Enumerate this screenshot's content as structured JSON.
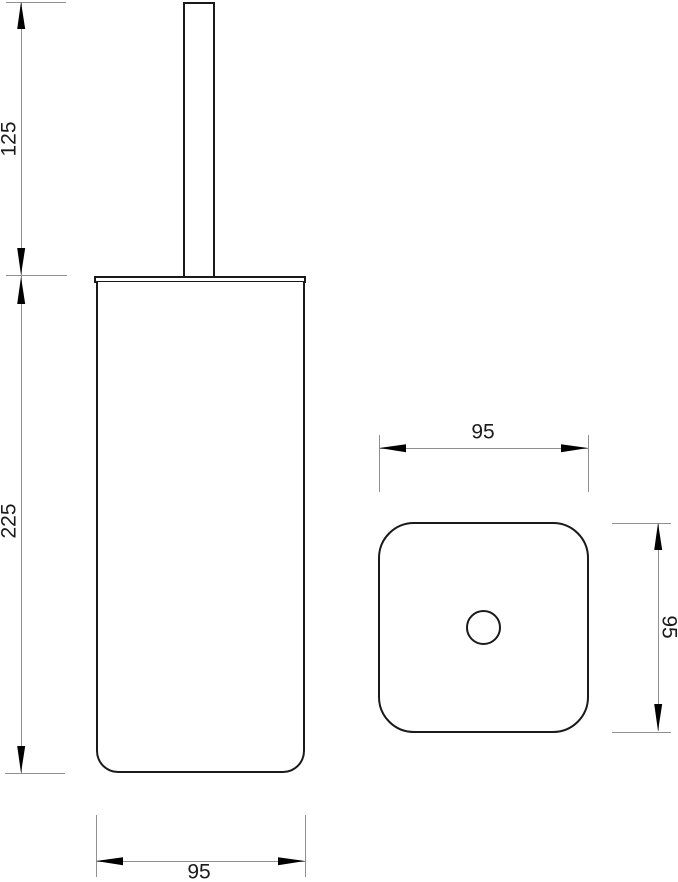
{
  "drawing": {
    "kind": "technical-dimension-drawing",
    "views": [
      "front",
      "top"
    ],
    "dims": {
      "front_upper_height": "125",
      "front_lower_height": "225",
      "front_width": "95",
      "top_width": "95",
      "top_depth": "95"
    },
    "colors": {
      "outline": "#1a1a1a",
      "dimension_line": "#909090",
      "arrow": "#000000",
      "text": "#1b1b1b",
      "background": "#ffffff"
    }
  }
}
